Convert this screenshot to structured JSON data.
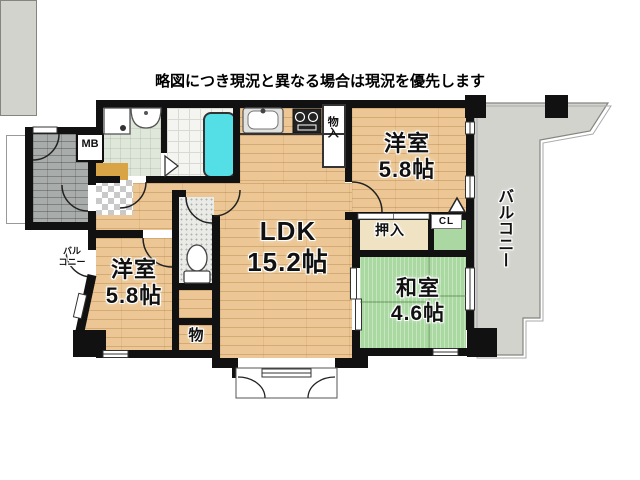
{
  "title": "略図につき現況と異なる場合は現況を優先します",
  "rooms": {
    "ldk": {
      "label": "LDK",
      "size": "15.2帖"
    },
    "bedroom_right": {
      "label": "洋室",
      "size": "5.8帖"
    },
    "bedroom_left": {
      "label": "洋室",
      "size": "5.8帖"
    },
    "japanese_room": {
      "label": "和室",
      "size": "4.6帖"
    },
    "balcony_right": {
      "label": "バルコニー"
    },
    "balcony_left": {
      "line1": "バル",
      "line2": "コニー"
    }
  },
  "closets": {
    "oshiire": "押入",
    "cl": "CL",
    "storage": "物",
    "storage_upper": "物入",
    "meter_box": "MB"
  },
  "colors": {
    "wood": "#ecc795",
    "tatami": "#a9d8a1",
    "balcony": "#d3d3ce",
    "bathtub": "#54dee6",
    "wall": "#111111",
    "entry_step": "#d9a445"
  }
}
